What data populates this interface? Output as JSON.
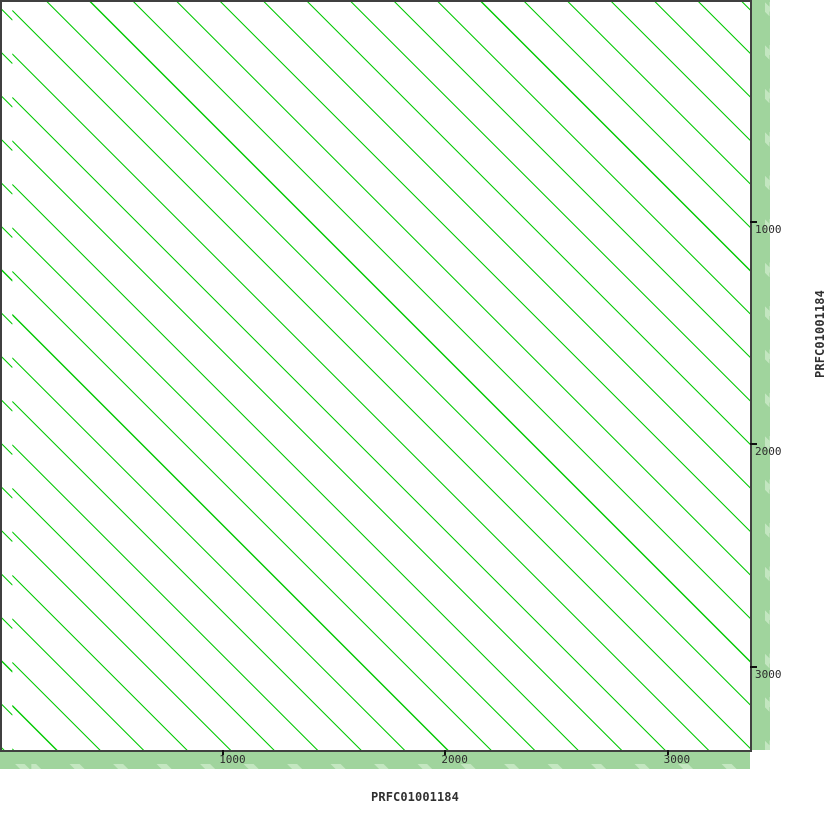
{
  "titles": {
    "x_axis": "PRFC01001184",
    "y_axis": "PRFC01001184"
  },
  "chart_data": {
    "type": "scatter",
    "subtype": "dna-self-dotplot",
    "title": "",
    "x_sequence_label": "PRFC01001184",
    "y_sequence_label": "PRFC01001184",
    "x_ticks_bp": [
      1000,
      2000,
      3000
    ],
    "y_ticks_bp": [
      1000,
      2000,
      3000
    ],
    "x_tick_labels": [
      "1000",
      "2000",
      "3000"
    ],
    "y_tick_labels": [
      "1000",
      "2000",
      "3000"
    ],
    "axis_range_bp": [
      0,
      3365
    ],
    "sequence_length_bp": 3365,
    "tandem_repeat_period_bp": 195,
    "diagonals_description": "forward-strand match diagonals parallel to the main identity diagonal at offsets of k x ~195 bp (k = -17 ... +17), spanning the entire plot area",
    "px_per_bp": 0.2222,
    "diagonal_spacing_px": 43.45,
    "legend": "none",
    "grid": "off",
    "colors": {
      "match_line_green": "#00c800",
      "index_bar_green": "#a0d49d",
      "bar_notch_green": "#c3e6c0",
      "plot_border_gray": "#404040",
      "tick_text": "#2b2b2b",
      "axis_title_text": "#303030",
      "background": "#ffffff"
    }
  }
}
